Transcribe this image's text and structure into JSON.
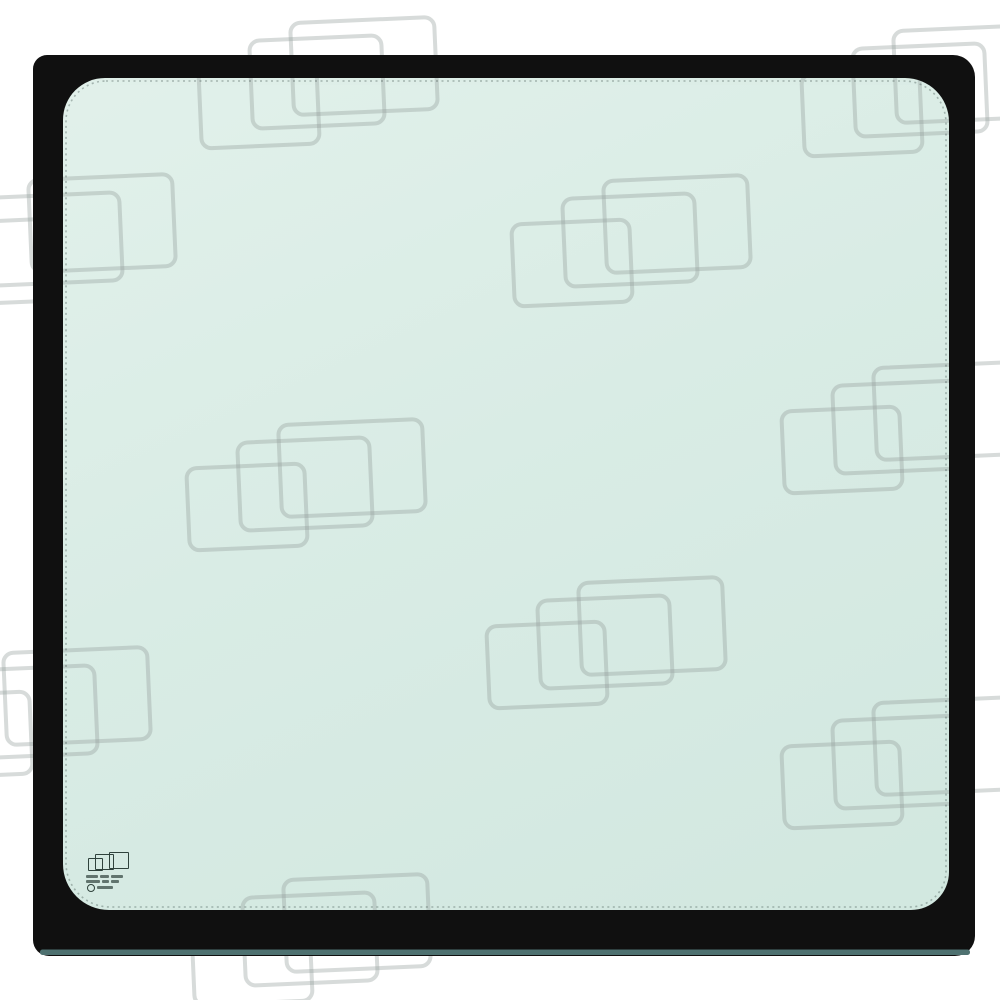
{
  "meta": {
    "content_type": "product-photo",
    "subject": "framed-glass-window-panel",
    "canvas": {
      "width": 1000,
      "height": 1000
    },
    "visible_text": "none-legible"
  },
  "colors": {
    "background": "#ffffff",
    "frame_black": "#101010",
    "frame_bottom_edge_teal": "#4e7170",
    "glass_light": "#e2f1eb",
    "glass_mid": "#d9ece5",
    "glass_deep": "#d1e7df",
    "glass_inner_shadow": "rgba(60,90,80,0.18)",
    "frit_dots": "rgba(10,30,25,0.28)",
    "watermark_stroke": "rgba(150,160,157,0.38)",
    "stamp_ink": "#2f423c"
  },
  "glass": {
    "x": 36,
    "y": 58,
    "w": 936,
    "h": 895,
    "r": 36,
    "gradient_angle_deg": 155
  },
  "frame": {
    "outer": {
      "x": 33,
      "y": 55,
      "w": 942,
      "h": 901,
      "radii": [
        14,
        22,
        20,
        16
      ]
    },
    "inner": {
      "x": 63,
      "y": 78,
      "w": 886,
      "h": 832,
      "radii": [
        42,
        44,
        38,
        46
      ]
    },
    "bottom_edge": {
      "x": 40,
      "y": 949.5,
      "w": 930,
      "h": 5.5,
      "r": 2.5
    },
    "frit": {
      "x": 66,
      "y": 81,
      "w": 880,
      "h": 826,
      "radii": [
        40,
        42,
        36,
        44
      ],
      "dash": "2 3.5",
      "width": 1.6
    }
  },
  "watermark": {
    "icon_name": "overlapping-rectangles-watermark-icon",
    "stroke_width": 4,
    "corner_radius": 12,
    "rect_rotation_deg": -2.5,
    "rect_template": [
      {
        "dx": 6,
        "dy": 44,
        "w": 114,
        "h": 78
      },
      {
        "dx": 57,
        "dy": 18,
        "w": 128,
        "h": 84
      },
      {
        "dx": 98,
        "dy": 0,
        "w": 140,
        "h": 88
      }
    ],
    "groups": [
      {
        "x": 192,
        "y": 18
      },
      {
        "x": 795,
        "y": 26
      },
      {
        "x": -70,
        "y": 175
      },
      {
        "x": 505,
        "y": 176
      },
      {
        "x": 775,
        "y": 363
      },
      {
        "x": 180,
        "y": 420
      },
      {
        "x": 480,
        "y": 578
      },
      {
        "x": -95,
        "y": 648
      },
      {
        "x": 775,
        "y": 698
      },
      {
        "x": 185,
        "y": 875
      }
    ]
  },
  "stamp": {
    "x": 86,
    "y": 851,
    "w": 48,
    "h": 42,
    "logo_icon": "three-overlapping-rectangles-icon",
    "cert_icon": "circle-mark-icon",
    "logo_rects": [
      {
        "x": 2,
        "y": 7,
        "w": 13,
        "h": 11
      },
      {
        "x": 9,
        "y": 3,
        "w": 17,
        "h": 14
      },
      {
        "x": 23,
        "y": 1,
        "w": 18,
        "h": 15
      }
    ],
    "text_rows": [
      {
        "y": 24,
        "bars": [
          12,
          9,
          12
        ]
      },
      {
        "y": 29,
        "bars": [
          14,
          7,
          8
        ]
      }
    ],
    "cert_row": {
      "y": 33,
      "circle": 6,
      "bar_w": 16
    }
  }
}
